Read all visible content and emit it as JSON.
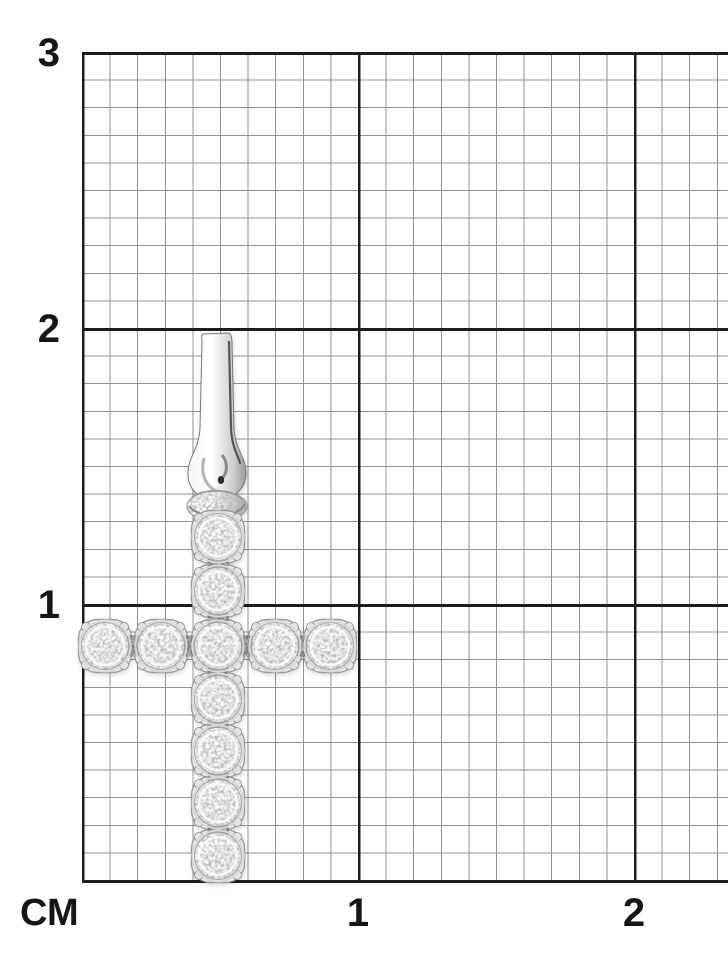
{
  "meta": {
    "alt": "White-gold diamond cross pendant photographed on centimeter grid paper"
  },
  "ruler": {
    "unit_label": "СМ",
    "left_tick_labels": [
      {
        "text": "3",
        "cm": 3
      },
      {
        "text": "2",
        "cm": 2
      },
      {
        "text": "1",
        "cm": 1
      }
    ],
    "bottom_tick_labels": [
      {
        "text": "1",
        "cm": 1
      },
      {
        "text": "2",
        "cm": 2
      }
    ]
  },
  "grid": {
    "origin_px": {
      "x": 82,
      "y": 880
    },
    "px_per_cm": 276,
    "px_per_mm": 27.6,
    "minor_line_color": "#929292",
    "major_line_color": "#1d1d1d",
    "paper_color": "#ffffff"
  },
  "pendant": {
    "type": "diamond-cross-pendant",
    "stone_shape": "round-brilliant",
    "stone_count": 11,
    "metal_color": "#ededed",
    "setting_stroke_color": "#9b9b9b",
    "connector_color": "#787878",
    "stone_radius": 23.5,
    "setting_half": 26.5,
    "column_x": 218,
    "row_y": 646,
    "vertical_stone_centers_y": [
      537,
      591,
      646,
      699,
      751,
      803,
      856
    ],
    "horizontal_stone_centers_x": [
      105,
      161,
      218,
      275,
      330
    ],
    "bail": {
      "center_x": 217,
      "top_y": 333,
      "knot_center_y": 506,
      "dot_color": "#2e2e2e"
    }
  }
}
